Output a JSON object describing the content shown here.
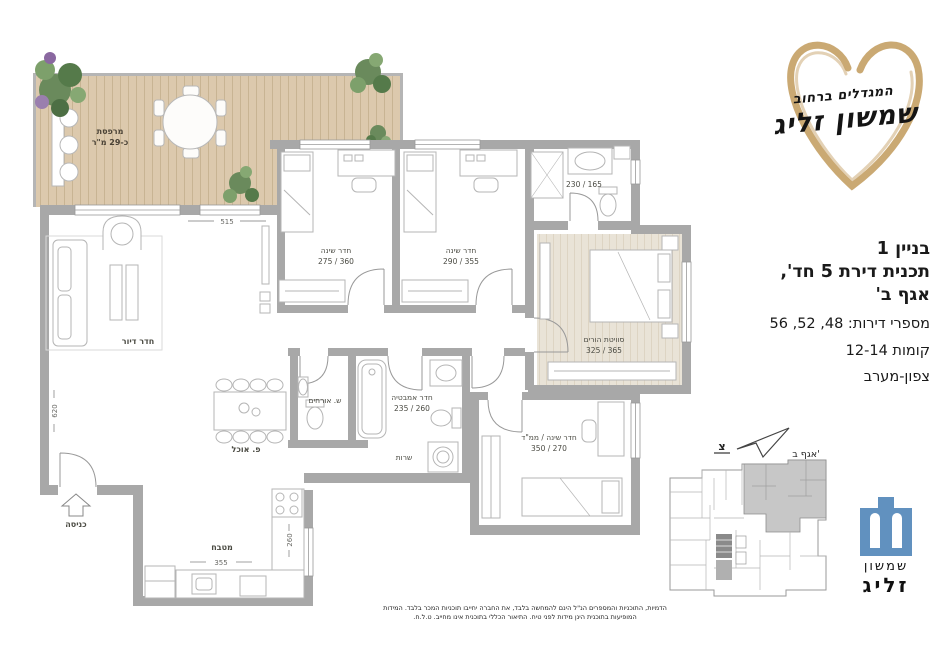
{
  "colors": {
    "walls": "#a8a8a8",
    "deck_wood": "#dcc9ad",
    "master_wood": "#e9e3d7",
    "accent_gold": "#c7a46c",
    "logo_blue": "#6191bf",
    "keyplan_highlight": "#c7c7c7"
  },
  "brand": {
    "tagline": "המגדלים ברחוב",
    "name": "שמשון זליג"
  },
  "info": {
    "building": "בניין 1",
    "plan_type": "תכנית דירת 5 חד',",
    "wing": "אגף ב'",
    "apartments": "מספרי דירות: 48, 52, 56",
    "floors": "קומות 12-14",
    "orientation": "צפון-מערב"
  },
  "keyplan": {
    "wing_label": "אגף ב'",
    "north_letter": "צ"
  },
  "company": {
    "name_top": "שמשון",
    "name_bottom": "זליג"
  },
  "plan": {
    "terrace": {
      "name": "מרפסת",
      "size": "כ-29 מ\"ר"
    },
    "living": {
      "name": "חדר דיור"
    },
    "dining": {
      "name": "פ. אוכל"
    },
    "kitchen": {
      "name": "מטבח",
      "dim_w": "355",
      "dim_h": "260"
    },
    "entrance": {
      "name": "כניסה"
    },
    "bedroom1": {
      "name": "חדר שינה",
      "size": "275 / 360"
    },
    "bedroom2": {
      "name": "חדר שינה",
      "size": "290 / 355"
    },
    "master": {
      "name": "סוויטת הורים",
      "size": "325 / 365"
    },
    "master_bath": {
      "size": "230 / 165"
    },
    "guest_wc": {
      "name": "ש. אורחים"
    },
    "bathroom": {
      "name": "חדר אמבטיה",
      "size": "235 / 260"
    },
    "laundry": {
      "name": "שרות"
    },
    "mamad": {
      "name": "חדר שינה / ממ\"ד",
      "size": "350 / 270"
    },
    "dims": {
      "top": "515",
      "left": "620"
    }
  },
  "disclaimer": {
    "line1": "הדמיות, התוכניות והמספרים הנ\"ל הינם להמחשה בלבד, את החברה יחייבו תוכניות המכר בלבד. המידות",
    "line2": "המופיעות בתוכנית הינן מידות לפני טיח. התיאור הכללי בתוכנית אינו מחייב. ט.ל.ח."
  }
}
